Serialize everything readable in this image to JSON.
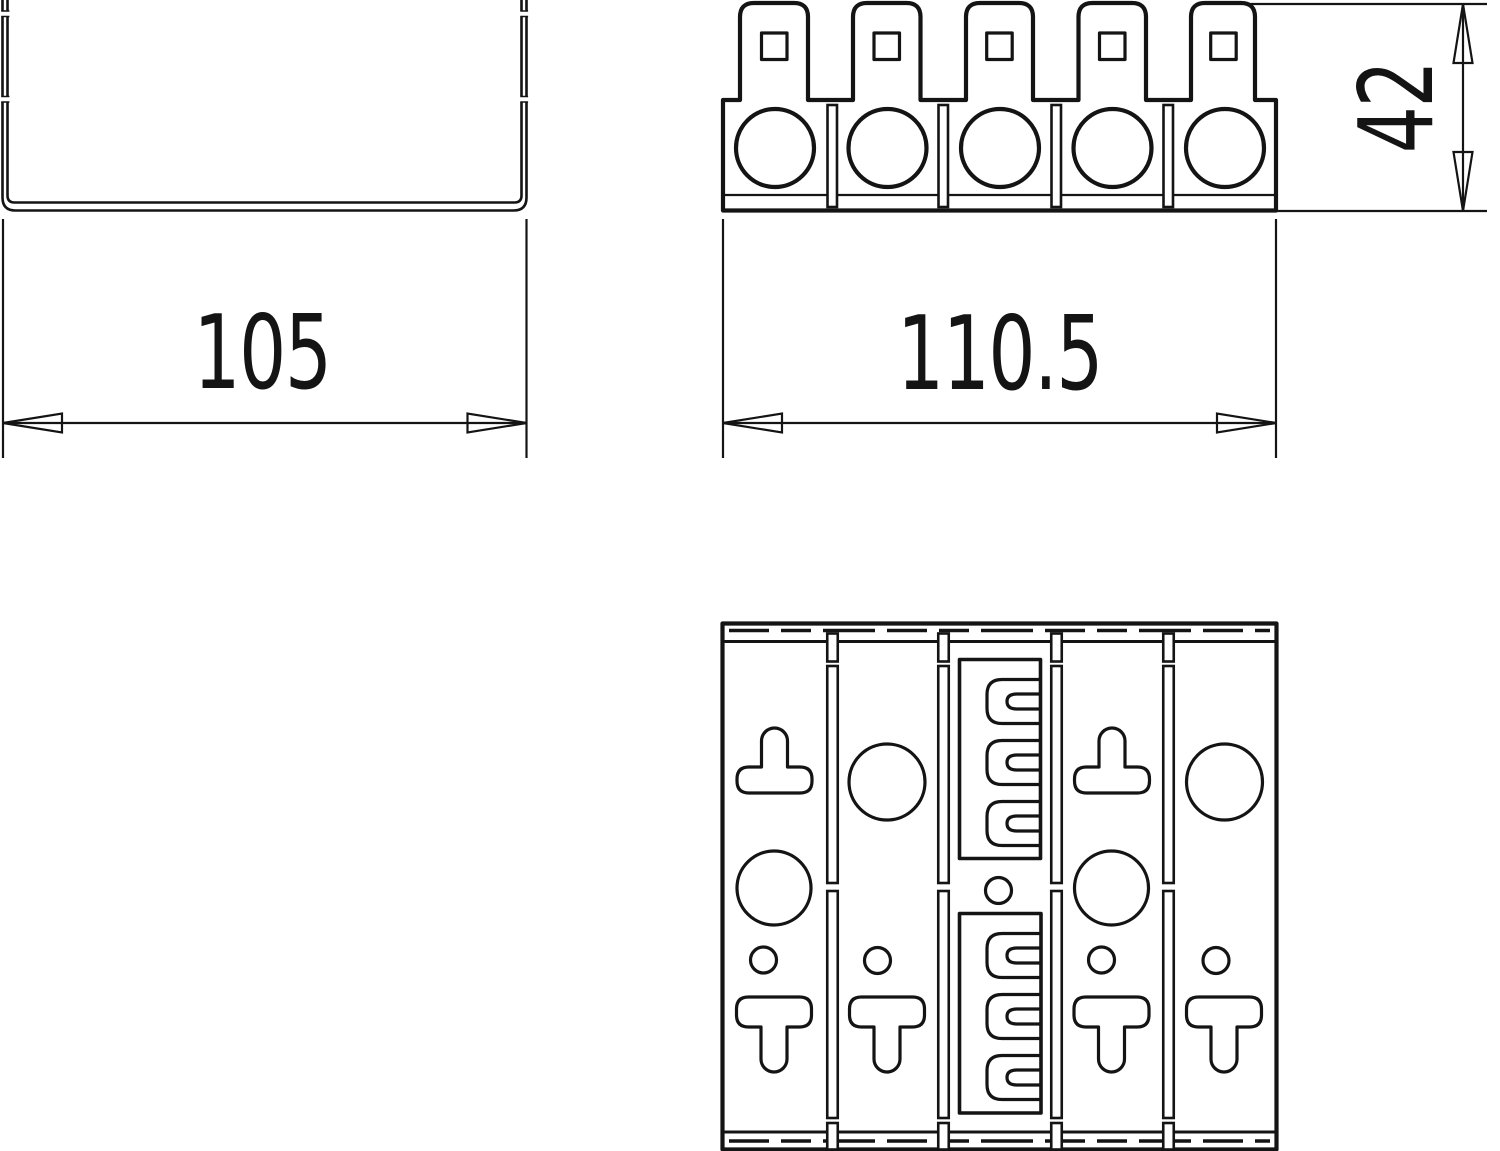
{
  "page": {
    "background": "#ffffff",
    "line_color": "#141414"
  },
  "dimensions": {
    "channel_width_label": "105",
    "block_width_label": "110.5",
    "block_height_label": "42"
  }
}
